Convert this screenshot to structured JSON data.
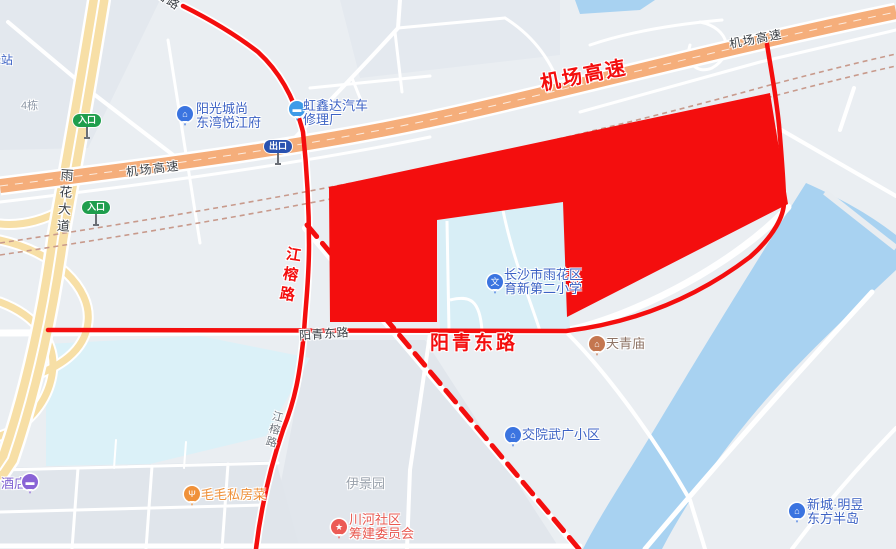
{
  "map": {
    "road_labels": {
      "airport_expressway": "机场高速",
      "yuhua_avenue": "雨花大道",
      "jiangrong_road": "江榕路",
      "yangqing_east_road": "阳青东路"
    },
    "badges": {
      "entrance": "入口",
      "exit": "出口"
    },
    "pois": {
      "station_partial": "驿站",
      "building_4": "4栋",
      "sunshine_city": {
        "line1": "阳光城尚",
        "line2": "东湾悦江府"
      },
      "car_repair": {
        "line1": "虹鑫达汽车",
        "line2": "修理厂"
      },
      "school": {
        "line1": "长沙市雨花区",
        "line2": "育新第二小学"
      },
      "tianqing_temple": "天青庙",
      "jiaoyuan_estate": "交院武广小区",
      "xincheng": {
        "line1": "新城·明昱",
        "line2": "东方半岛"
      },
      "yijingyuan": "伊景园",
      "chuanhe_committee": {
        "line1": "川河社区",
        "line2": "筹建委员会"
      },
      "maomao_restaurant": "毛毛私房菜",
      "hotel": "酒店"
    },
    "icon_glyphs": {
      "school": "文",
      "building": "⌂",
      "temple": "⌂",
      "star": "★",
      "food": "Ψ",
      "block": "▬"
    },
    "colors": {
      "highlight_red": "#F40E0E",
      "expressway_orange": "#F5AE7B",
      "highway_cream": "#F7DFA6",
      "river_blue": "#A8D2F1",
      "pond_cyan": "#D9EFF8",
      "poi_blue": "#3C62C4",
      "poi_orange": "#EE8F38",
      "poi_purple": "#7E60D2",
      "poi_coral": "#E85951",
      "poi_brown": "#8D7365"
    }
  }
}
